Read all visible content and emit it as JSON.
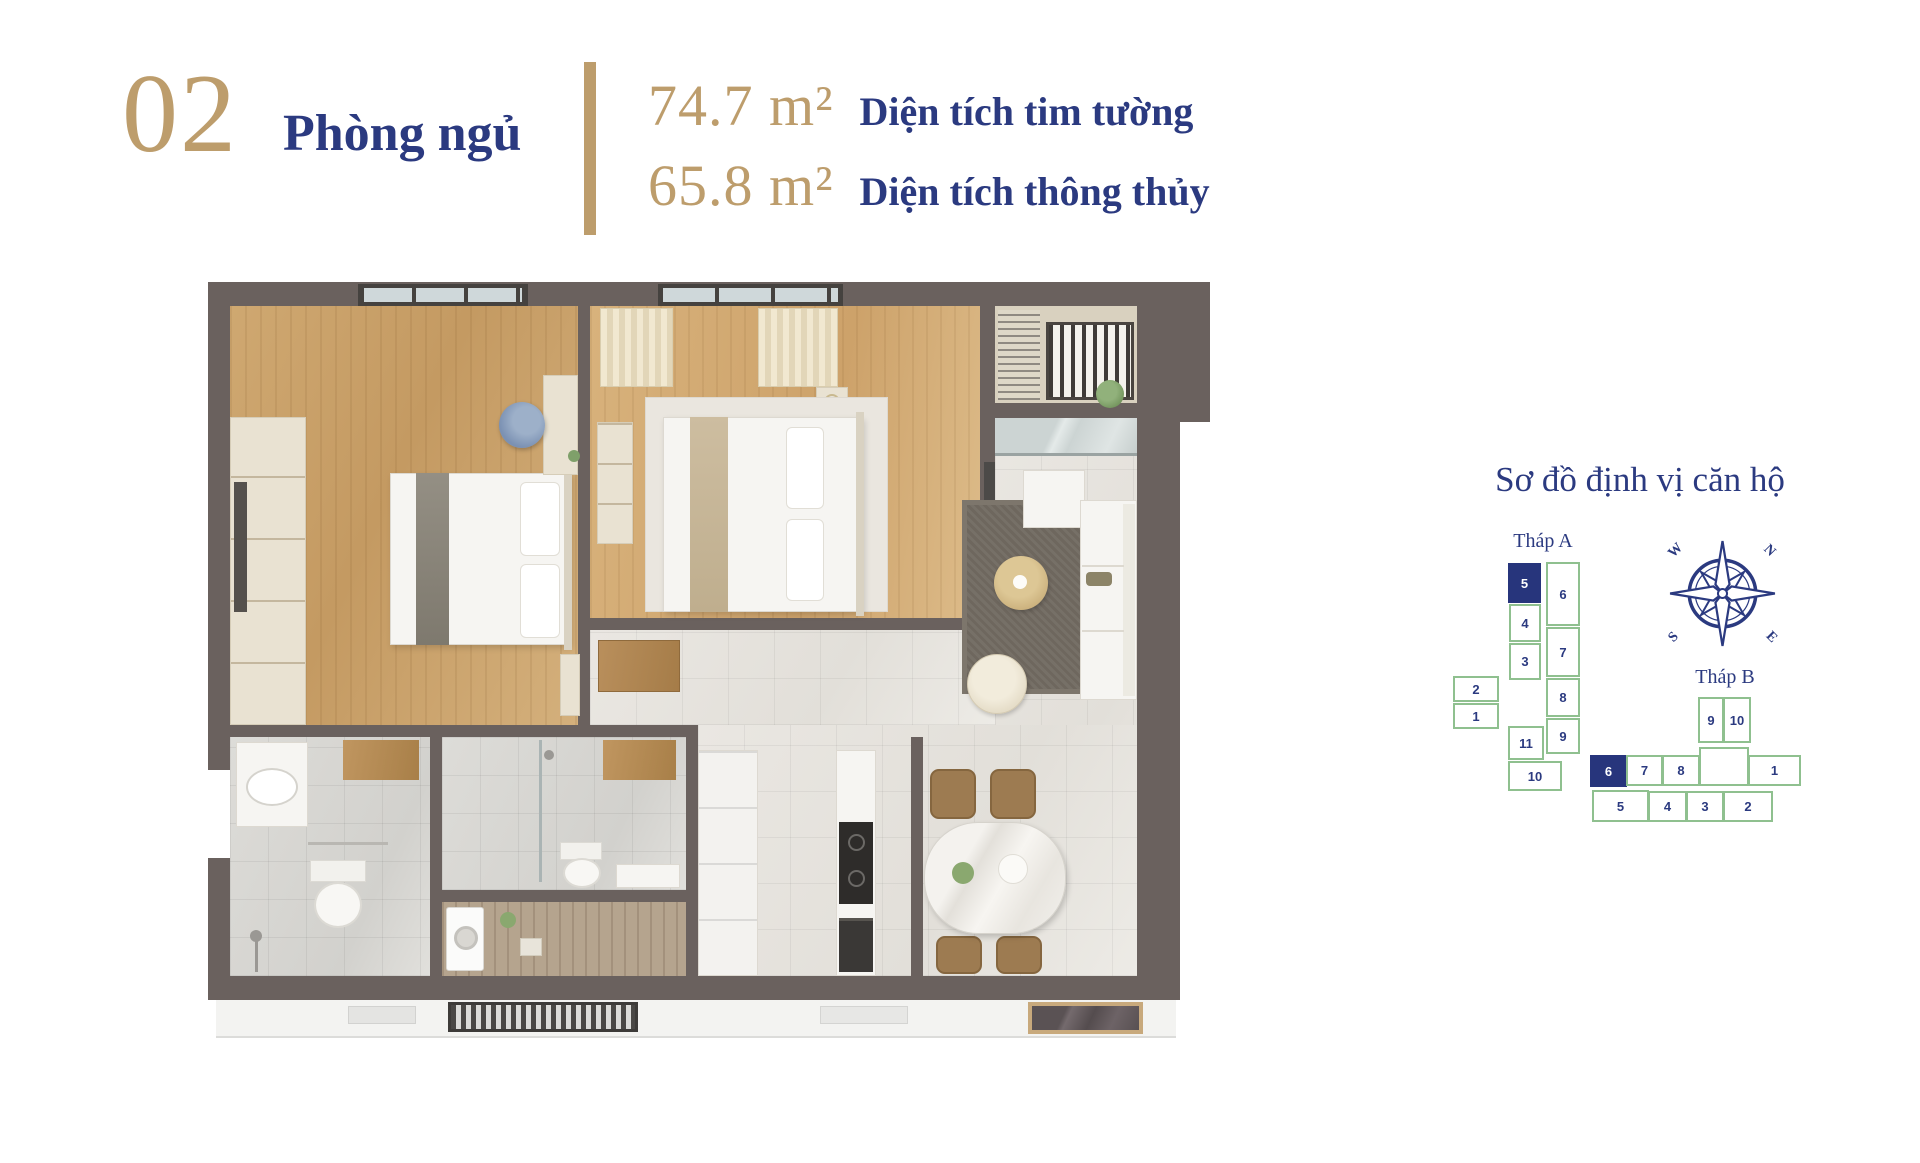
{
  "header": {
    "unit_number": "02",
    "unit_type_label": "Phòng ngủ",
    "areas": [
      {
        "value": "74.7 m²",
        "label": "Diện tích tim tường"
      },
      {
        "value": "65.8 m²",
        "label": "Diện tích thông thủy"
      }
    ]
  },
  "locator": {
    "title": "Sơ đồ định vị căn hộ",
    "tower_a": {
      "name": "Tháp A",
      "highlighted_unit": "5",
      "units": [
        {
          "label": "5",
          "highlighted": true
        },
        {
          "label": "6"
        },
        {
          "label": "4"
        },
        {
          "label": "3"
        },
        {
          "label": "7"
        },
        {
          "label": "8"
        },
        {
          "label": "9"
        },
        {
          "label": "2"
        },
        {
          "label": "1"
        },
        {
          "label": "11"
        },
        {
          "label": "10"
        }
      ]
    },
    "tower_b": {
      "name": "Tháp B",
      "highlighted_unit": "6",
      "units": [
        {
          "label": "9"
        },
        {
          "label": "10"
        },
        {
          "label": "6",
          "highlighted": true
        },
        {
          "label": "7"
        },
        {
          "label": "8"
        },
        {
          "label": ""
        },
        {
          "label": "1"
        },
        {
          "label": "5"
        },
        {
          "label": "4"
        },
        {
          "label": "3"
        },
        {
          "label": "2"
        }
      ]
    },
    "compass": {
      "w": "W",
      "n": "N",
      "s": "S",
      "e": "E"
    }
  },
  "colors": {
    "accent_gold": "#bd9d6c",
    "navy": "#2b3a80",
    "diagram_green": "#8fc08f",
    "wall_taupe": "#6a615e"
  }
}
